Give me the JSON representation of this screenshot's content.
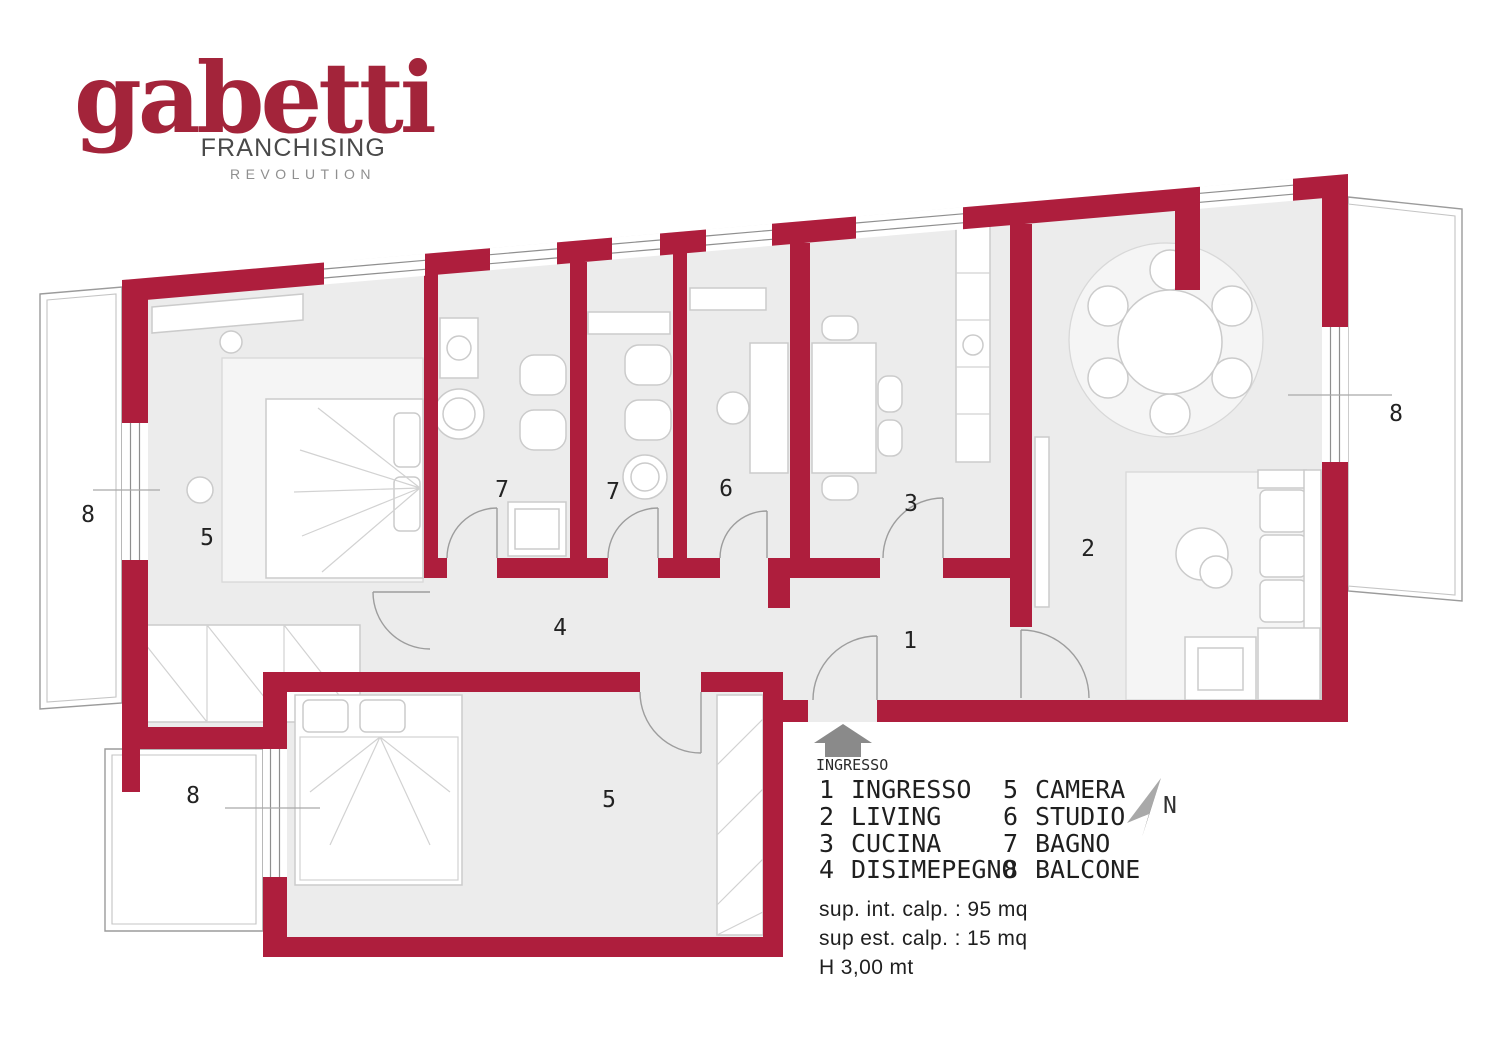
{
  "brand": {
    "name": "gabetti",
    "line1": "FRANCHISING",
    "line2": "REVOLUTION"
  },
  "colors": {
    "wall_red": "#AE1E3D",
    "logo_red": "#A3243A",
    "floor_gray": "#ECECEC",
    "outline_gray": "#9B9B9B",
    "text_dark": "#1F1F1F"
  },
  "legend": {
    "items": [
      {
        "num": "1",
        "label": "INGRESSO"
      },
      {
        "num": "2",
        "label": "LIVING"
      },
      {
        "num": "3",
        "label": "CUCINA"
      },
      {
        "num": "4",
        "label": "DISIMEPEGNO"
      },
      {
        "num": "5",
        "label": "CAMERA"
      },
      {
        "num": "6",
        "label": "STUDIO"
      },
      {
        "num": "7",
        "label": "BAGNO"
      },
      {
        "num": "8",
        "label": "BALCONE"
      }
    ]
  },
  "entrance": {
    "label": "INGRESSO"
  },
  "compass": {
    "label": "N"
  },
  "measurements": {
    "line1": "sup. int. calp. : 95 mq",
    "line2": "sup est. calp. : 15 mq",
    "line3": "H 3,00 mt"
  }
}
